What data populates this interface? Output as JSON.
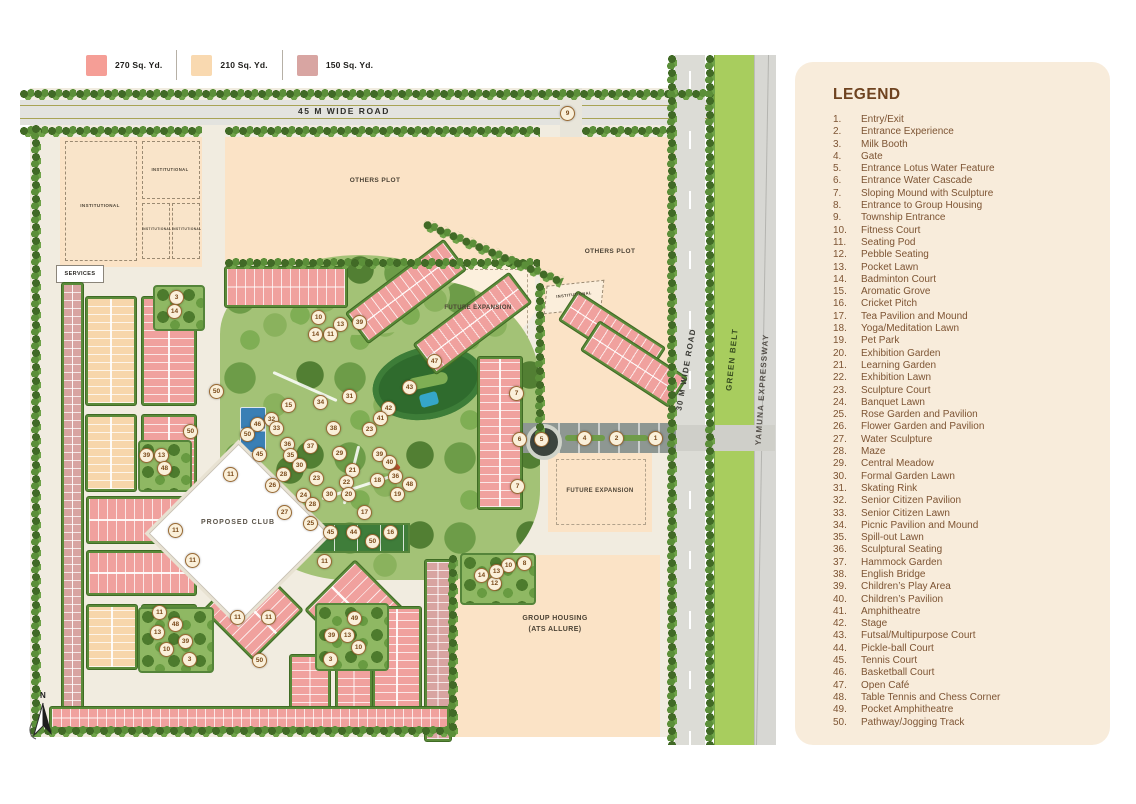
{
  "plot_size_legend": {
    "items": [
      {
        "label": "270 Sq. Yd.",
        "color": "#f59e96"
      },
      {
        "label": "210 Sq. Yd.",
        "color": "#f9d9b0"
      },
      {
        "label": "150 Sq. Yd.",
        "color": "#d8a5a2"
      }
    ]
  },
  "legend": {
    "title": "LEGEND",
    "items": [
      {
        "num": "1.",
        "label": "Entry/Exit"
      },
      {
        "num": "2.",
        "label": "Entrance Experience"
      },
      {
        "num": "3.",
        "label": "Milk Booth"
      },
      {
        "num": "4.",
        "label": "Gate"
      },
      {
        "num": "5.",
        "label": "Entrance Lotus Water Feature"
      },
      {
        "num": "6.",
        "label": "Entrance Water Cascade"
      },
      {
        "num": "7.",
        "label": "Sloping Mound with Sculpture"
      },
      {
        "num": "8.",
        "label": "Entrance to Group Housing"
      },
      {
        "num": "9.",
        "label": "Township Entrance"
      },
      {
        "num": "10.",
        "label": "Fitness Court"
      },
      {
        "num": "11.",
        "label": "Seating Pod"
      },
      {
        "num": "12.",
        "label": "Pebble Seating"
      },
      {
        "num": "13.",
        "label": "Pocket Lawn"
      },
      {
        "num": "14.",
        "label": "Badminton Court"
      },
      {
        "num": "15.",
        "label": "Aromatic Grove"
      },
      {
        "num": "16.",
        "label": "Cricket Pitch"
      },
      {
        "num": "17.",
        "label": "Tea Pavilion and Mound"
      },
      {
        "num": "18.",
        "label": "Yoga/Meditation Lawn"
      },
      {
        "num": "19.",
        "label": "Pet Park"
      },
      {
        "num": "20.",
        "label": "Exhibition Garden"
      },
      {
        "num": "21.",
        "label": "Learning Garden"
      },
      {
        "num": "22.",
        "label": "Exhibition Lawn"
      },
      {
        "num": "23.",
        "label": "Sculpture Court"
      },
      {
        "num": "24.",
        "label": "Banquet Lawn"
      },
      {
        "num": "25.",
        "label": "Rose Garden and Pavilion"
      },
      {
        "num": "26.",
        "label": "Flower Garden and Pavilion"
      },
      {
        "num": "27.",
        "label": "Water Sculpture"
      },
      {
        "num": "28.",
        "label": "Maze"
      },
      {
        "num": "29.",
        "label": "Central Meadow"
      },
      {
        "num": "30.",
        "label": "Formal Garden Lawn"
      },
      {
        "num": "31.",
        "label": "Skating Rink"
      },
      {
        "num": "32.",
        "label": "Senior Citizen Pavilion"
      },
      {
        "num": "33.",
        "label": "Senior Citizen Lawn"
      },
      {
        "num": "34.",
        "label": "Picnic Pavilion and Mound"
      },
      {
        "num": "35.",
        "label": "Spill-out Lawn"
      },
      {
        "num": "36.",
        "label": "Sculptural Seating"
      },
      {
        "num": "37.",
        "label": "Hammock Garden"
      },
      {
        "num": "38.",
        "label": "English Bridge"
      },
      {
        "num": "39.",
        "label": "Children’s Play Area"
      },
      {
        "num": "40.",
        "label": "Children’s Pavilion"
      },
      {
        "num": "41.",
        "label": "Amphitheatre"
      },
      {
        "num": "42.",
        "label": "Stage"
      },
      {
        "num": "43.",
        "label": "Futsal/Multipurpose Court"
      },
      {
        "num": "44.",
        "label": "Pickle-ball Court"
      },
      {
        "num": "45.",
        "label": "Tennis Court"
      },
      {
        "num": "46.",
        "label": "Basketball Court"
      },
      {
        "num": "47.",
        "label": "Open Café"
      },
      {
        "num": "48.",
        "label": "Table Tennis and Chess Corner"
      },
      {
        "num": "49.",
        "label": "Pocket Amphitheatre"
      },
      {
        "num": "50.",
        "label": "Pathway/Jogging Track"
      }
    ]
  },
  "map": {
    "road_labels": {
      "road_45m": "45 M WIDE ROAD",
      "road_30m": "30 M WIDE ROAD",
      "green_belt": "GREEN BELT",
      "expressway": "YAMUNA EXPRESSWAY"
    },
    "area_labels": {
      "institutional": "INSTITUTIONAL",
      "services": "SERVICES",
      "others_plot_1": "OTHERS PLOT",
      "others_plot_2": "OTHERS PLOT",
      "future_expansion_1": "FUTURE EXPANSION",
      "future_expansion_2": "FUTURE EXPANSION",
      "institutional_small": "INSTITUTIONAL",
      "proposed_club": "PROPOSED CLUB",
      "group_housing_1": "GROUP HOUSING",
      "group_housing_2": "(ATS ALLURE)"
    },
    "compass_label": "N",
    "markers": [
      {
        "n": "1",
        "x": 634,
        "y": 382
      },
      {
        "n": "2",
        "x": 595,
        "y": 382
      },
      {
        "n": "4",
        "x": 563,
        "y": 382
      },
      {
        "n": "5",
        "x": 520,
        "y": 383
      },
      {
        "n": "6",
        "x": 498,
        "y": 383
      },
      {
        "n": "7",
        "x": 495,
        "y": 337
      },
      {
        "n": "7",
        "x": 496,
        "y": 430
      },
      {
        "n": "9",
        "x": 546,
        "y": 57
      },
      {
        "n": "8",
        "x": 503,
        "y": 507
      },
      {
        "n": "10",
        "x": 487,
        "y": 509
      },
      {
        "n": "12",
        "x": 473,
        "y": 527
      },
      {
        "n": "13",
        "x": 475,
        "y": 515
      },
      {
        "n": "14",
        "x": 460,
        "y": 519
      },
      {
        "n": "10",
        "x": 297,
        "y": 261
      },
      {
        "n": "13",
        "x": 319,
        "y": 268
      },
      {
        "n": "39",
        "x": 338,
        "y": 266
      },
      {
        "n": "11",
        "x": 309,
        "y": 278
      },
      {
        "n": "14",
        "x": 294,
        "y": 278
      },
      {
        "n": "47",
        "x": 413,
        "y": 305
      },
      {
        "n": "43",
        "x": 388,
        "y": 331
      },
      {
        "n": "42",
        "x": 367,
        "y": 352
      },
      {
        "n": "41",
        "x": 359,
        "y": 362
      },
      {
        "n": "31",
        "x": 328,
        "y": 340
      },
      {
        "n": "34",
        "x": 299,
        "y": 346
      },
      {
        "n": "15",
        "x": 267,
        "y": 349
      },
      {
        "n": "32",
        "x": 250,
        "y": 363
      },
      {
        "n": "33",
        "x": 255,
        "y": 372
      },
      {
        "n": "46",
        "x": 236,
        "y": 368
      },
      {
        "n": "50",
        "x": 226,
        "y": 378
      },
      {
        "n": "45",
        "x": 238,
        "y": 398
      },
      {
        "n": "36",
        "x": 266,
        "y": 388
      },
      {
        "n": "37",
        "x": 289,
        "y": 390
      },
      {
        "n": "35",
        "x": 269,
        "y": 399
      },
      {
        "n": "30",
        "x": 278,
        "y": 409
      },
      {
        "n": "38",
        "x": 312,
        "y": 372
      },
      {
        "n": "23",
        "x": 348,
        "y": 373
      },
      {
        "n": "29",
        "x": 318,
        "y": 397
      },
      {
        "n": "39",
        "x": 358,
        "y": 398
      },
      {
        "n": "40",
        "x": 368,
        "y": 406
      },
      {
        "n": "18",
        "x": 356,
        "y": 424
      },
      {
        "n": "36",
        "x": 374,
        "y": 420
      },
      {
        "n": "48",
        "x": 388,
        "y": 428
      },
      {
        "n": "19",
        "x": 376,
        "y": 438
      },
      {
        "n": "21",
        "x": 331,
        "y": 414
      },
      {
        "n": "22",
        "x": 325,
        "y": 426
      },
      {
        "n": "23",
        "x": 295,
        "y": 422
      },
      {
        "n": "30",
        "x": 308,
        "y": 438
      },
      {
        "n": "20",
        "x": 327,
        "y": 438
      },
      {
        "n": "24",
        "x": 282,
        "y": 439
      },
      {
        "n": "28",
        "x": 262,
        "y": 418
      },
      {
        "n": "26",
        "x": 251,
        "y": 429
      },
      {
        "n": "27",
        "x": 263,
        "y": 456
      },
      {
        "n": "25",
        "x": 289,
        "y": 467
      },
      {
        "n": "28",
        "x": 291,
        "y": 448
      },
      {
        "n": "17",
        "x": 343,
        "y": 456
      },
      {
        "n": "16",
        "x": 369,
        "y": 476
      },
      {
        "n": "44",
        "x": 332,
        "y": 476
      },
      {
        "n": "45",
        "x": 309,
        "y": 476
      },
      {
        "n": "50",
        "x": 351,
        "y": 485
      },
      {
        "n": "11",
        "x": 209,
        "y": 418
      },
      {
        "n": "11",
        "x": 171,
        "y": 504
      },
      {
        "n": "11",
        "x": 303,
        "y": 505
      },
      {
        "n": "11",
        "x": 216,
        "y": 561
      },
      {
        "n": "11",
        "x": 247,
        "y": 561
      },
      {
        "n": "11",
        "x": 138,
        "y": 556
      },
      {
        "n": "11",
        "x": 154,
        "y": 474
      },
      {
        "n": "3",
        "x": 155,
        "y": 241
      },
      {
        "n": "14",
        "x": 153,
        "y": 255
      },
      {
        "n": "39",
        "x": 125,
        "y": 399
      },
      {
        "n": "13",
        "x": 140,
        "y": 399
      },
      {
        "n": "48",
        "x": 143,
        "y": 412
      },
      {
        "n": "48",
        "x": 154,
        "y": 568
      },
      {
        "n": "13",
        "x": 136,
        "y": 576
      },
      {
        "n": "39",
        "x": 164,
        "y": 585
      },
      {
        "n": "10",
        "x": 145,
        "y": 593
      },
      {
        "n": "3",
        "x": 168,
        "y": 603
      },
      {
        "n": "50",
        "x": 238,
        "y": 604
      },
      {
        "n": "49",
        "x": 333,
        "y": 562
      },
      {
        "n": "39",
        "x": 310,
        "y": 579
      },
      {
        "n": "13",
        "x": 326,
        "y": 579
      },
      {
        "n": "10",
        "x": 337,
        "y": 591
      },
      {
        "n": "3",
        "x": 309,
        "y": 603
      },
      {
        "n": "50",
        "x": 195,
        "y": 335
      },
      {
        "n": "50",
        "x": 169,
        "y": 375
      }
    ]
  }
}
